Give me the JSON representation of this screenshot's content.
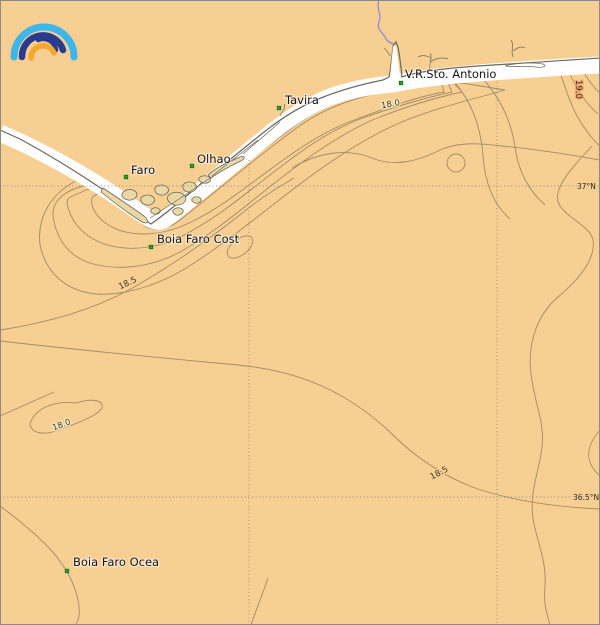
{
  "map": {
    "description": "Sea surface temperature contour map of the Algarve coast (southern Portugal)",
    "places": [
      {
        "label": "Faro"
      },
      {
        "label": "Olhao"
      },
      {
        "label": "Tavira"
      },
      {
        "label": "V.R.Sto. Antonio"
      }
    ],
    "buoys": [
      {
        "label": "Boia Faro Cost"
      },
      {
        "label": "Boia Faro Ocea"
      }
    ],
    "isotherm_values_celsius": [
      18.0,
      18.5,
      19.0
    ],
    "isotherm_labels": [
      {
        "text": "18.0"
      },
      {
        "text": "18.5"
      },
      {
        "text": "18.0"
      },
      {
        "text": "18.5"
      },
      {
        "text": "19.0"
      }
    ],
    "graticule_labels": [
      {
        "text": "37°N"
      },
      {
        "text": "36.5°N"
      }
    ],
    "logo": {
      "icon": "rainbow-arcs-logo"
    },
    "colors": {
      "land": "#e9d7a4",
      "sea": "#f8cf92",
      "coastal_band_1_lightest": "#fcf4d9",
      "coastal_band_2": "#f9ebc2",
      "coastal_band_3": "#f7e1ad",
      "coastal_band_4": "#f5d79a",
      "warm_patch": "#f19c66",
      "cool_blob": "#faeec7",
      "contour_line": "#a08c66",
      "coastline": "#6b675c",
      "no_data_band": "#ffffff",
      "grid": "#8c8c8c",
      "marker_green": "#27a82f",
      "river": "#8a8fd0",
      "logo_lightblue": "#3db6ea",
      "logo_darkblue": "#2a3b8f",
      "logo_orange": "#f6a72e"
    }
  }
}
